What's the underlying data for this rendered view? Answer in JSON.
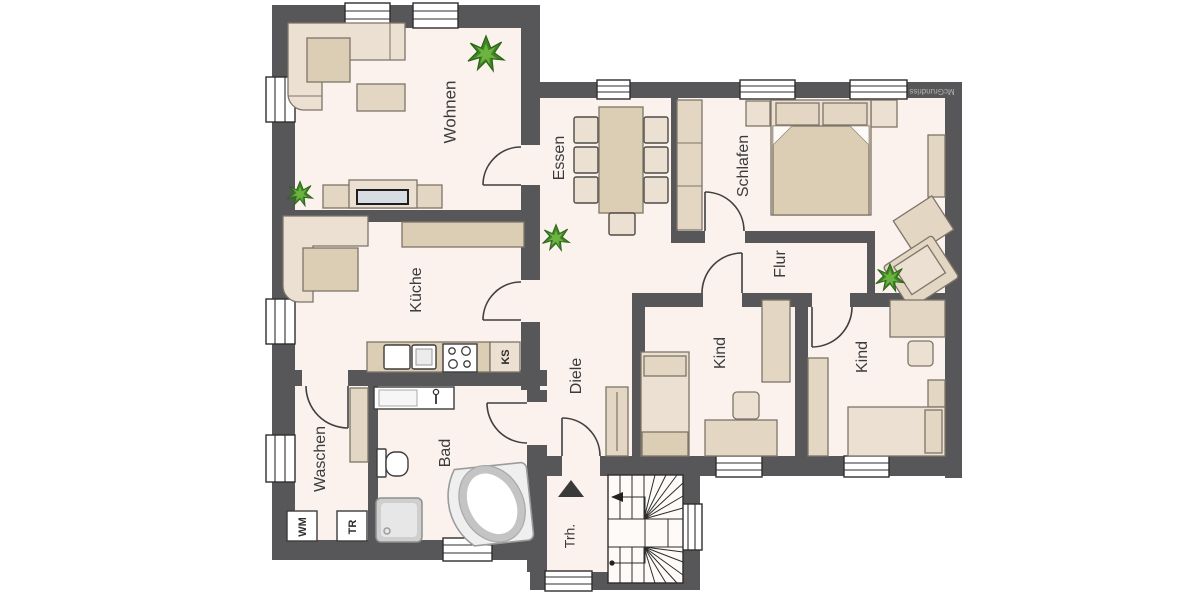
{
  "watermark": "McGrundriss",
  "colors": {
    "background": "#ffffff",
    "wall": "#575659",
    "floor": "#fbf1ed",
    "furniture": "#ebe0d2",
    "furniture_mid": "#e3d6c3",
    "furniture_dark": "#dccdb5",
    "outline": "#7d7568",
    "plant": "#3f8427"
  },
  "rooms": {
    "wohnen": {
      "label": "Wohnen",
      "furniture": [
        "corner-sofa",
        "coffee-table",
        "tv-sideboard",
        "tv",
        "plant",
        "plant"
      ]
    },
    "essen": {
      "label": "Essen",
      "furniture": [
        "dining-table",
        "six-side-chairs",
        "end-chair",
        "plant"
      ]
    },
    "schlafen": {
      "label": "Schlafen",
      "furniture": [
        "double-bed",
        "nightstand",
        "nightstand",
        "tall-cabinet",
        "wardrobe",
        "side-table",
        "armchair",
        "plant"
      ]
    },
    "kueche": {
      "label": "Küche",
      "furniture": [
        "corner-bench",
        "table",
        "wall-counter",
        "kitchen-counter",
        "sink",
        "stove",
        "fridge"
      ]
    },
    "flur": {
      "label": "Flur",
      "furniture": []
    },
    "diele": {
      "label": "Diele",
      "furniture": [
        "wardrobe"
      ]
    },
    "kind1": {
      "label": "Kind",
      "furniture": [
        "bed",
        "wardrobe",
        "desk",
        "chair"
      ]
    },
    "kind2": {
      "label": "Kind",
      "furniture": [
        "bed",
        "wardrobe",
        "desk",
        "chair",
        "shelf"
      ]
    },
    "waschen": {
      "label": "Waschen",
      "furniture": [
        "tall-cabinet",
        "washing-machine",
        "dryer"
      ]
    },
    "bad": {
      "label": "Bad",
      "furniture": [
        "vanity-sink",
        "toilet",
        "shower",
        "corner-bathtub"
      ]
    },
    "trh": {
      "label": "Trh.",
      "furniture": [
        "winder-staircase"
      ]
    }
  },
  "appliances": {
    "ks": "KS",
    "wm": "WM",
    "tr": "TR"
  },
  "icons": {
    "stair_direction_arrow": "up-triangle",
    "stair_walk_arrow": "left-arrow",
    "plant": "green-starburst",
    "shower_drain": "circle"
  }
}
